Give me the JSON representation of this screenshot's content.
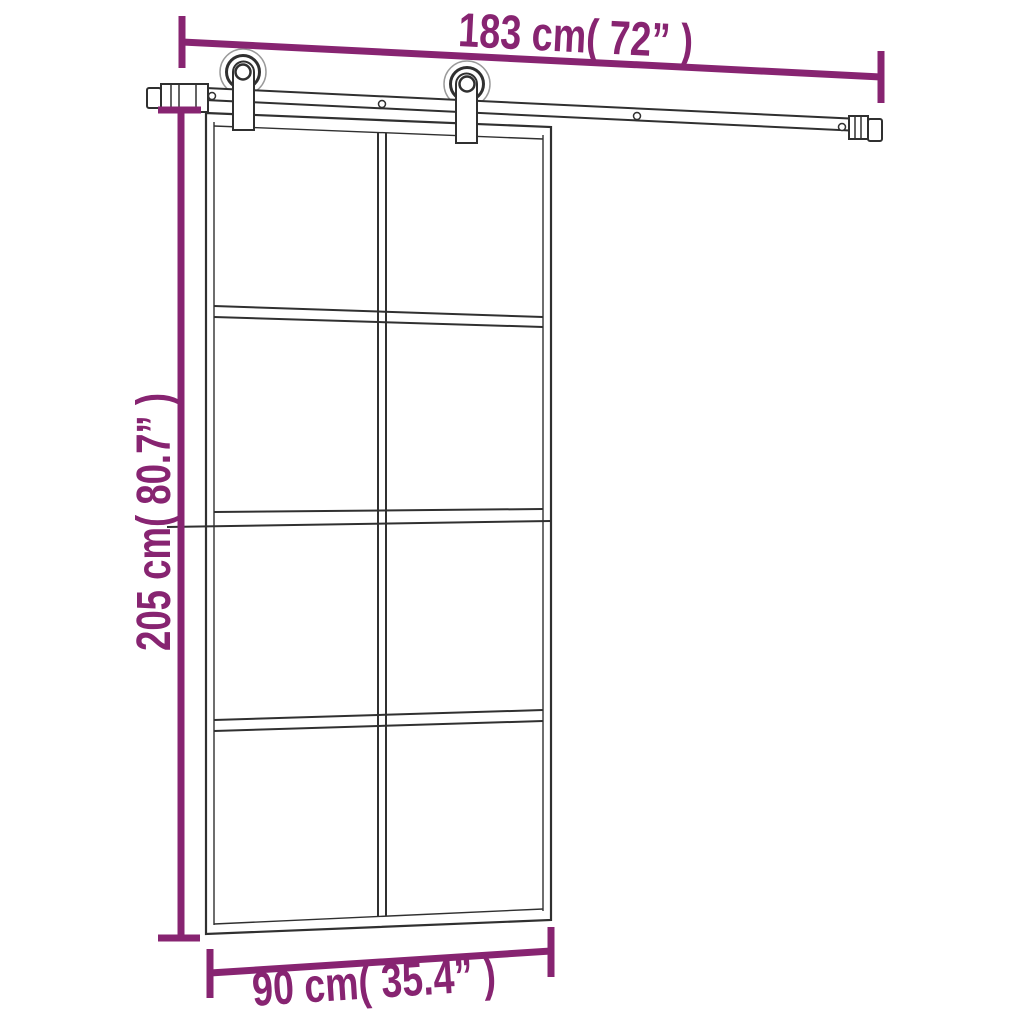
{
  "canvas": {
    "width": 1024,
    "height": 1024,
    "background": "#ffffff"
  },
  "diagram": {
    "type": "product-dimension-diagram",
    "subject": "sliding glass door with top rail hardware kit",
    "line_color": "#303030",
    "soft_line_color": "#9a9a9a",
    "accent_color": "#872471",
    "labels": {
      "rail_width": "183 cm( 72” )",
      "door_height": "205 cm( 80.7” )",
      "door_width": "90 cm( 35.4” )"
    },
    "measurements": {
      "rail_width": {
        "cm": 183,
        "inches": 72
      },
      "door_height": {
        "cm": 205,
        "inches": 80.7
      },
      "door_width": {
        "cm": 90,
        "inches": 35.4
      }
    },
    "door": {
      "glass_panel_columns": 2,
      "glass_panel_rows": 4,
      "glass_panel_count": 8,
      "roller_count": 2
    }
  }
}
